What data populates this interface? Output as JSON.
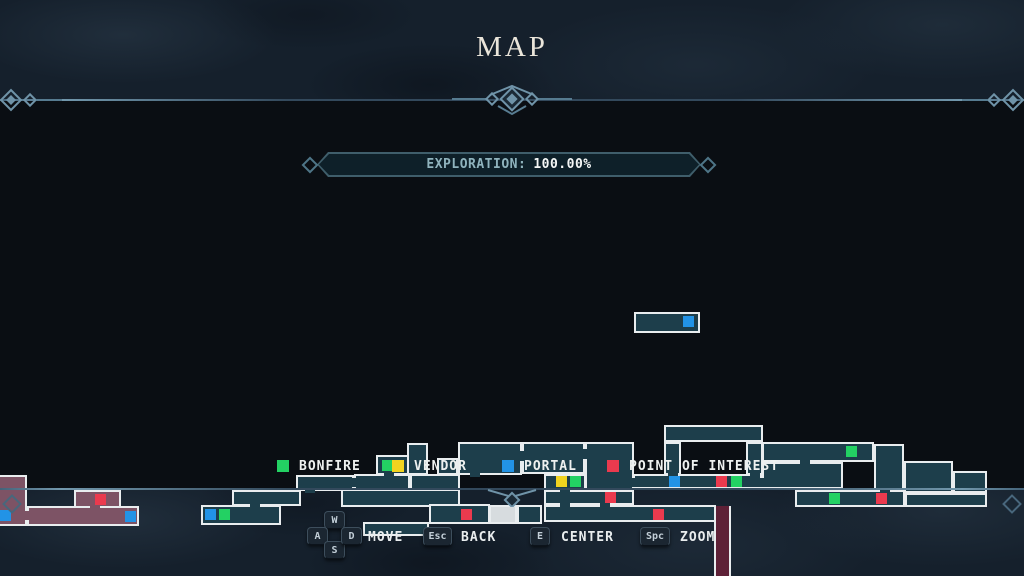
{
  "header": {
    "title": "MAP"
  },
  "exploration": {
    "label": "EXPLORATION:",
    "value": "100.00%"
  },
  "legend": {
    "items": [
      {
        "name": "bonfire",
        "label": "BONFIRE",
        "x": 277
      },
      {
        "name": "vendor",
        "label": "VENDOR",
        "x": 392
      },
      {
        "name": "portal",
        "label": "PORTAL",
        "x": 502
      },
      {
        "name": "poi",
        "label": "POINT OF INTEREST",
        "x": 607
      }
    ]
  },
  "controls": {
    "move": {
      "keys": [
        "W",
        "A",
        "S",
        "D"
      ],
      "label": "MOVE"
    },
    "back": {
      "key": "Esc",
      "label": "BACK"
    },
    "center": {
      "key": "E",
      "label": "CENTER"
    },
    "zoom": {
      "key": "Spc",
      "label": "ZOOM"
    }
  },
  "map": {
    "colors": {
      "room": "#1d3e4b",
      "region_pink": "#7d5365",
      "room_highlight": "#d7dcdf",
      "wall": "#e9edef",
      "shaft": "#5e2137",
      "map_bg": "#0a0e13",
      "frame_bg": "#15202c",
      "accent": "#6f93a8",
      "bonfire": "#23d163",
      "vendor": "#f2d31f",
      "portal": "#2293e6",
      "poi": "#ea3a4e"
    },
    "rooms": [
      {
        "x": 634,
        "y": 211,
        "w": 66,
        "h": 21
      },
      {
        "x": 0,
        "y": 374,
        "w": 27,
        "h": 51,
        "fill": "region_pink",
        "noLeft": true
      },
      {
        "x": 27,
        "y": 405,
        "w": 112,
        "h": 20,
        "fill": "region_pink"
      },
      {
        "x": 74,
        "y": 389,
        "w": 47,
        "h": 18,
        "fill": "region_pink"
      },
      {
        "x": 201,
        "y": 404,
        "w": 80,
        "h": 20
      },
      {
        "x": 232,
        "y": 389,
        "w": 69,
        "h": 16
      },
      {
        "x": 296,
        "y": 374,
        "w": 58,
        "h": 16
      },
      {
        "x": 354,
        "y": 373,
        "w": 56,
        "h": 16
      },
      {
        "x": 410,
        "y": 373,
        "w": 50,
        "h": 16
      },
      {
        "x": 376,
        "y": 354,
        "w": 33,
        "h": 20
      },
      {
        "x": 407,
        "y": 342,
        "w": 21,
        "h": 32
      },
      {
        "x": 437,
        "y": 357,
        "w": 21,
        "h": 17
      },
      {
        "x": 458,
        "y": 341,
        "w": 64,
        "h": 33
      },
      {
        "x": 522,
        "y": 341,
        "w": 63,
        "h": 32
      },
      {
        "x": 585,
        "y": 341,
        "w": 49,
        "h": 48
      },
      {
        "x": 544,
        "y": 373,
        "w": 42,
        "h": 16
      },
      {
        "x": 544,
        "y": 389,
        "w": 90,
        "h": 15
      },
      {
        "x": 544,
        "y": 404,
        "w": 172,
        "h": 17
      },
      {
        "x": 341,
        "y": 388,
        "w": 119,
        "h": 18
      },
      {
        "x": 363,
        "y": 421,
        "w": 66,
        "h": 14
      },
      {
        "x": 429,
        "y": 403,
        "w": 61,
        "h": 20
      },
      {
        "x": 489,
        "y": 404,
        "w": 28,
        "h": 19,
        "fill": "room_highlight"
      },
      {
        "x": 517,
        "y": 404,
        "w": 25,
        "h": 19
      },
      {
        "x": 633,
        "y": 373,
        "w": 129,
        "h": 15
      },
      {
        "x": 664,
        "y": 324,
        "w": 99,
        "h": 17
      },
      {
        "x": 664,
        "y": 341,
        "w": 17,
        "h": 33
      },
      {
        "x": 746,
        "y": 341,
        "w": 17,
        "h": 33
      },
      {
        "x": 762,
        "y": 341,
        "w": 112,
        "h": 20
      },
      {
        "x": 762,
        "y": 361,
        "w": 81,
        "h": 27
      },
      {
        "x": 874,
        "y": 343,
        "w": 30,
        "h": 49
      },
      {
        "x": 904,
        "y": 360,
        "w": 49,
        "h": 32
      },
      {
        "x": 795,
        "y": 389,
        "w": 110,
        "h": 17
      },
      {
        "x": 953,
        "y": 370,
        "w": 34,
        "h": 22
      },
      {
        "x": 905,
        "y": 392,
        "w": 82,
        "h": 14
      },
      {
        "x": 714,
        "y": 405,
        "w": 17,
        "h": 85,
        "fill": "shaft",
        "sides": "lr"
      }
    ],
    "doors": [
      {
        "x": 250,
        "y": 401,
        "w": 10,
        "h": 6
      },
      {
        "x": 305,
        "y": 386,
        "w": 10,
        "h": 6
      },
      {
        "x": 351,
        "y": 377,
        "w": 6,
        "h": 9
      },
      {
        "x": 384,
        "y": 370,
        "w": 10,
        "h": 6
      },
      {
        "x": 470,
        "y": 370,
        "w": 10,
        "h": 6
      },
      {
        "x": 519,
        "y": 350,
        "w": 5,
        "h": 10
      },
      {
        "x": 582,
        "y": 348,
        "w": 5,
        "h": 10
      },
      {
        "x": 560,
        "y": 386,
        "w": 10,
        "h": 6
      },
      {
        "x": 560,
        "y": 401,
        "w": 10,
        "h": 6
      },
      {
        "x": 600,
        "y": 401,
        "w": 10,
        "h": 6
      },
      {
        "x": 630,
        "y": 377,
        "w": 6,
        "h": 9
      },
      {
        "x": 668,
        "y": 370,
        "w": 10,
        "h": 6
      },
      {
        "x": 750,
        "y": 370,
        "w": 10,
        "h": 6
      },
      {
        "x": 759,
        "y": 377,
        "w": 6,
        "h": 9
      },
      {
        "x": 800,
        "y": 358,
        "w": 10,
        "h": 6
      },
      {
        "x": 880,
        "y": 389,
        "w": 10,
        "h": 6
      },
      {
        "x": 24,
        "y": 410,
        "w": 6,
        "h": 9,
        "fill": "region_pink"
      },
      {
        "x": 90,
        "y": 402,
        "w": 10,
        "h": 6,
        "fill": "region_pink"
      }
    ],
    "markers": [
      {
        "type": "portal",
        "x": 683,
        "y": 215
      },
      {
        "type": "portal",
        "x": 205,
        "y": 408
      },
      {
        "type": "bonfire",
        "x": 219,
        "y": 408
      },
      {
        "type": "bonfire",
        "x": 382,
        "y": 359
      },
      {
        "type": "vendor",
        "x": 556,
        "y": 375
      },
      {
        "type": "bonfire",
        "x": 570,
        "y": 375
      },
      {
        "type": "poi",
        "x": 605,
        "y": 391
      },
      {
        "type": "poi",
        "x": 461,
        "y": 408
      },
      {
        "type": "poi",
        "x": 653,
        "y": 408
      },
      {
        "type": "portal",
        "x": 669,
        "y": 375
      },
      {
        "type": "poi",
        "x": 716,
        "y": 375
      },
      {
        "type": "bonfire",
        "x": 731,
        "y": 375
      },
      {
        "type": "bonfire",
        "x": 846,
        "y": 345
      },
      {
        "type": "bonfire",
        "x": 829,
        "y": 392
      },
      {
        "type": "poi",
        "x": 876,
        "y": 392
      },
      {
        "type": "portal",
        "x": 0,
        "y": 409
      },
      {
        "type": "poi",
        "x": 95,
        "y": 393
      },
      {
        "type": "portal",
        "x": 125,
        "y": 410
      }
    ]
  }
}
